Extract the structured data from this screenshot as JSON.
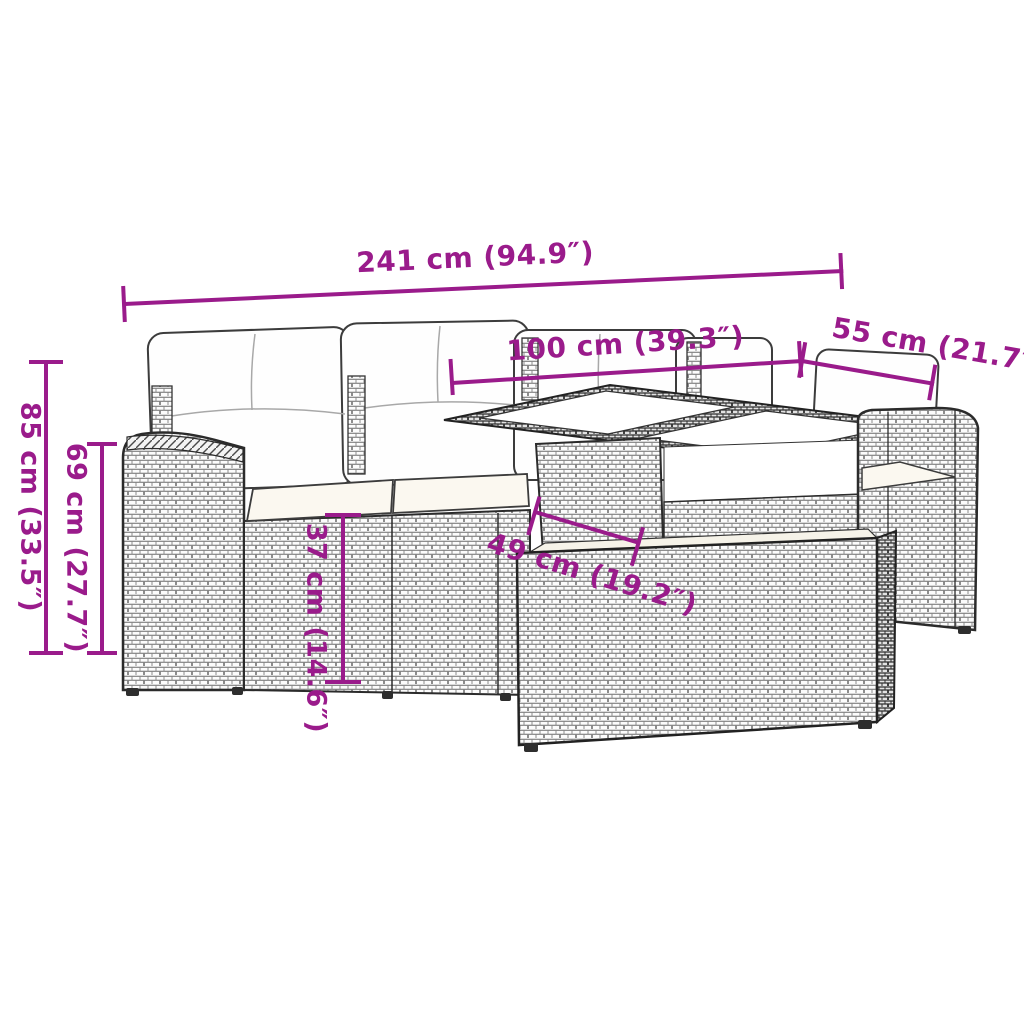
{
  "diagram": {
    "type": "product-dimension-diagram",
    "product": "poly-rattan garden lounge set with table and ottoman",
    "accent_color": "#9A1B8B",
    "outline_color": "#333333",
    "measurements": {
      "total_width": "241 cm (94.9″)",
      "tabletop_width": "100 cm (39.3″)",
      "tabletop_depth": "55 cm (21.7″)",
      "total_height": "85 cm (33.5″)",
      "arm_height": "69 cm (27.7″)",
      "seat_height": "37 cm (14.6″)",
      "table_inner_depth": "49 cm (19.2″)"
    }
  }
}
